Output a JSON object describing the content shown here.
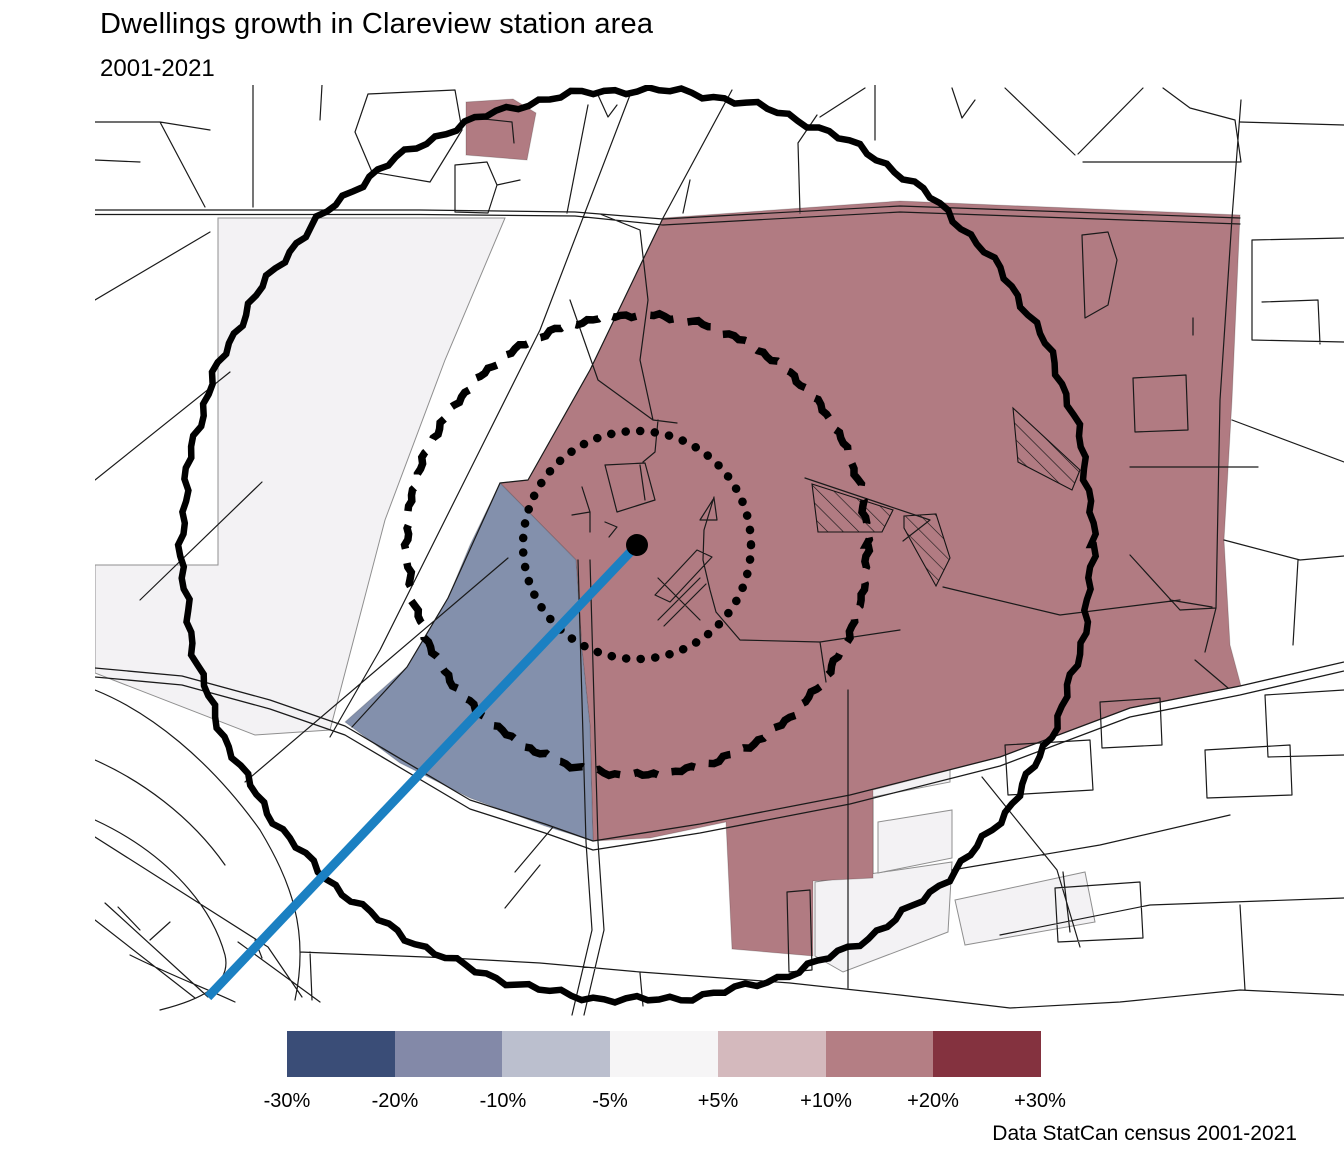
{
  "title": "Dwellings growth in Clareview station area",
  "subtitle": "2001-2021",
  "attribution": "Data StatCan census 2001-2021",
  "legend": {
    "labels": [
      "-30%",
      "-20%",
      "-10%",
      "-5%",
      "+5%",
      "+10%",
      "+20%",
      "+30%"
    ],
    "colors": [
      "#3a4d77",
      "#8389a8",
      "#bbbfce",
      "#f6f5f6",
      "#d4b9bd",
      "#b47e84",
      "#84323f"
    ],
    "bins": [
      {
        "range": "-30% to -20%",
        "color": "#3a4d77"
      },
      {
        "range": "-20% to -10%",
        "color": "#8389a8"
      },
      {
        "range": "-10% to -5%",
        "color": "#bbbfce"
      },
      {
        "range": "-5% to +5%",
        "color": "#f6f5f6"
      },
      {
        "range": "+5% to +10%",
        "color": "#d4b9bd"
      },
      {
        "range": "+10% to +20%",
        "color": "#b47e84"
      },
      {
        "range": "+20% to +30%",
        "color": "#84323f"
      }
    ]
  },
  "colors": {
    "map_growth_region": "#b17b82",
    "map_decline_region": "#8390ac",
    "neutral_parcel": "#f3f2f4",
    "parcel_outline": "#8f8f8f",
    "road": "#1a1a1a",
    "ring": "#000000",
    "lrt_line": "#1b80c2",
    "station_dot": "#000000"
  },
  "map": {
    "station": {
      "name": "Clareview station",
      "cx": 637,
      "cy": 545,
      "dot_radius": 11
    },
    "rings": {
      "dotted_radius": 114,
      "dashed_radius": 230,
      "solid_radius": 455
    },
    "regions": {
      "growth_bin": "+10% to +20%",
      "decline_bin": "-20% to -10%"
    }
  }
}
